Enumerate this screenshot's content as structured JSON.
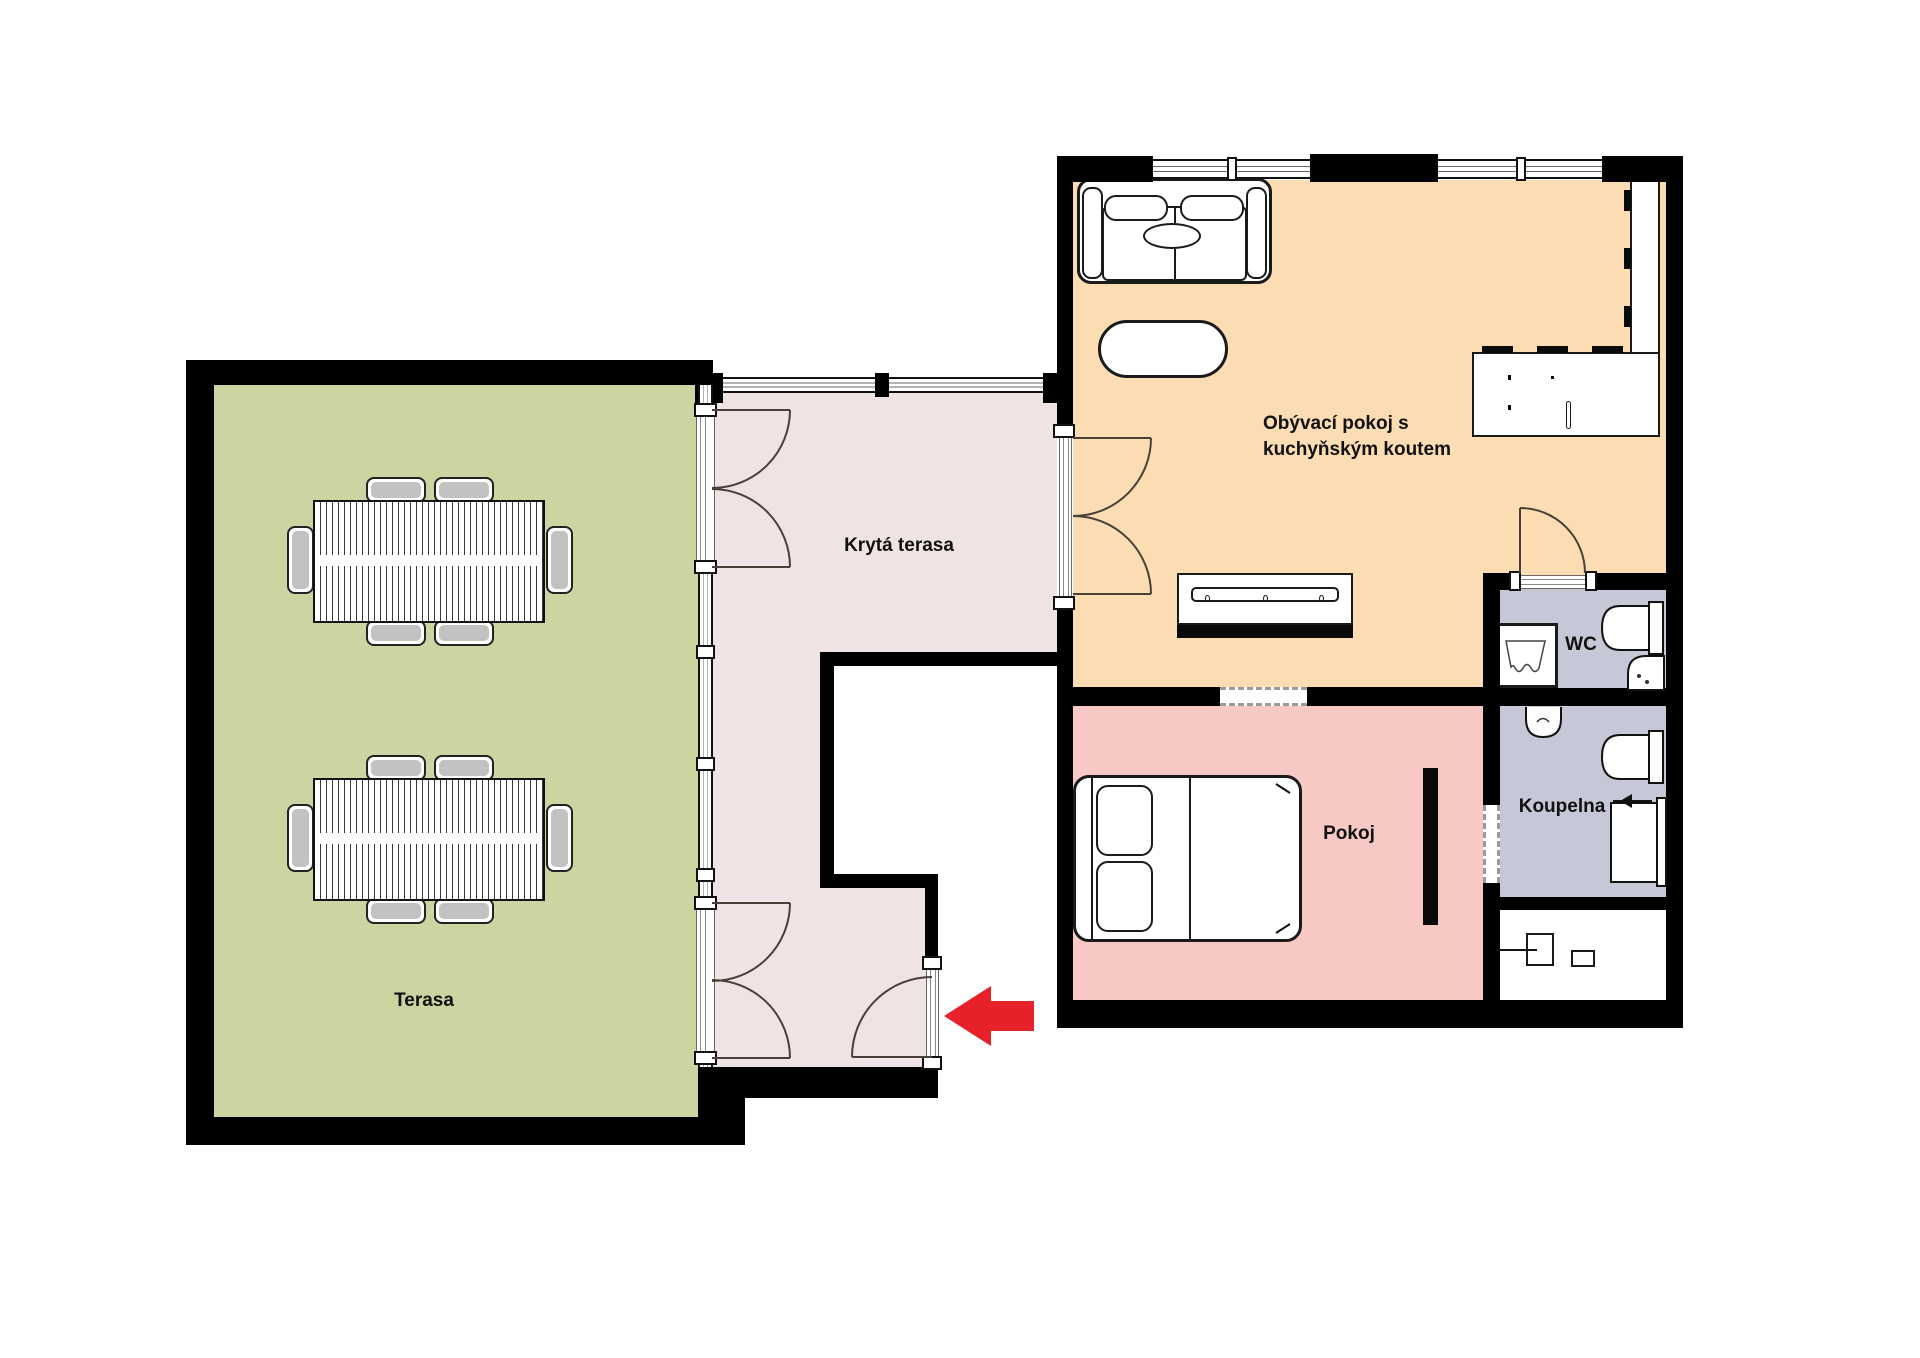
{
  "rooms": {
    "terrace": {
      "label": "Terasa",
      "color": "#ccd5a2"
    },
    "covered_terrace": {
      "label": "Krytá terasa",
      "color": "#f0e3e3"
    },
    "living_room": {
      "label_line1": "Obývací pokoj s",
      "label_line2": "kuchyňským koutem",
      "color": "#fbdcb3"
    },
    "bedroom": {
      "label": "Pokoj",
      "color": "#f8c9c4"
    },
    "wc": {
      "label": "WC",
      "color": "#c6c8d8"
    },
    "bathroom": {
      "label": "Koupelna",
      "color": "#c6c8d8"
    },
    "utility": {
      "color": "#ffffff"
    },
    "outside_recess": {
      "color": "#ffffff"
    }
  },
  "colors": {
    "wall": "#000000",
    "door_arc": "#4a4038",
    "entrance_arrow": "#e62129",
    "background": "#ffffff"
  }
}
